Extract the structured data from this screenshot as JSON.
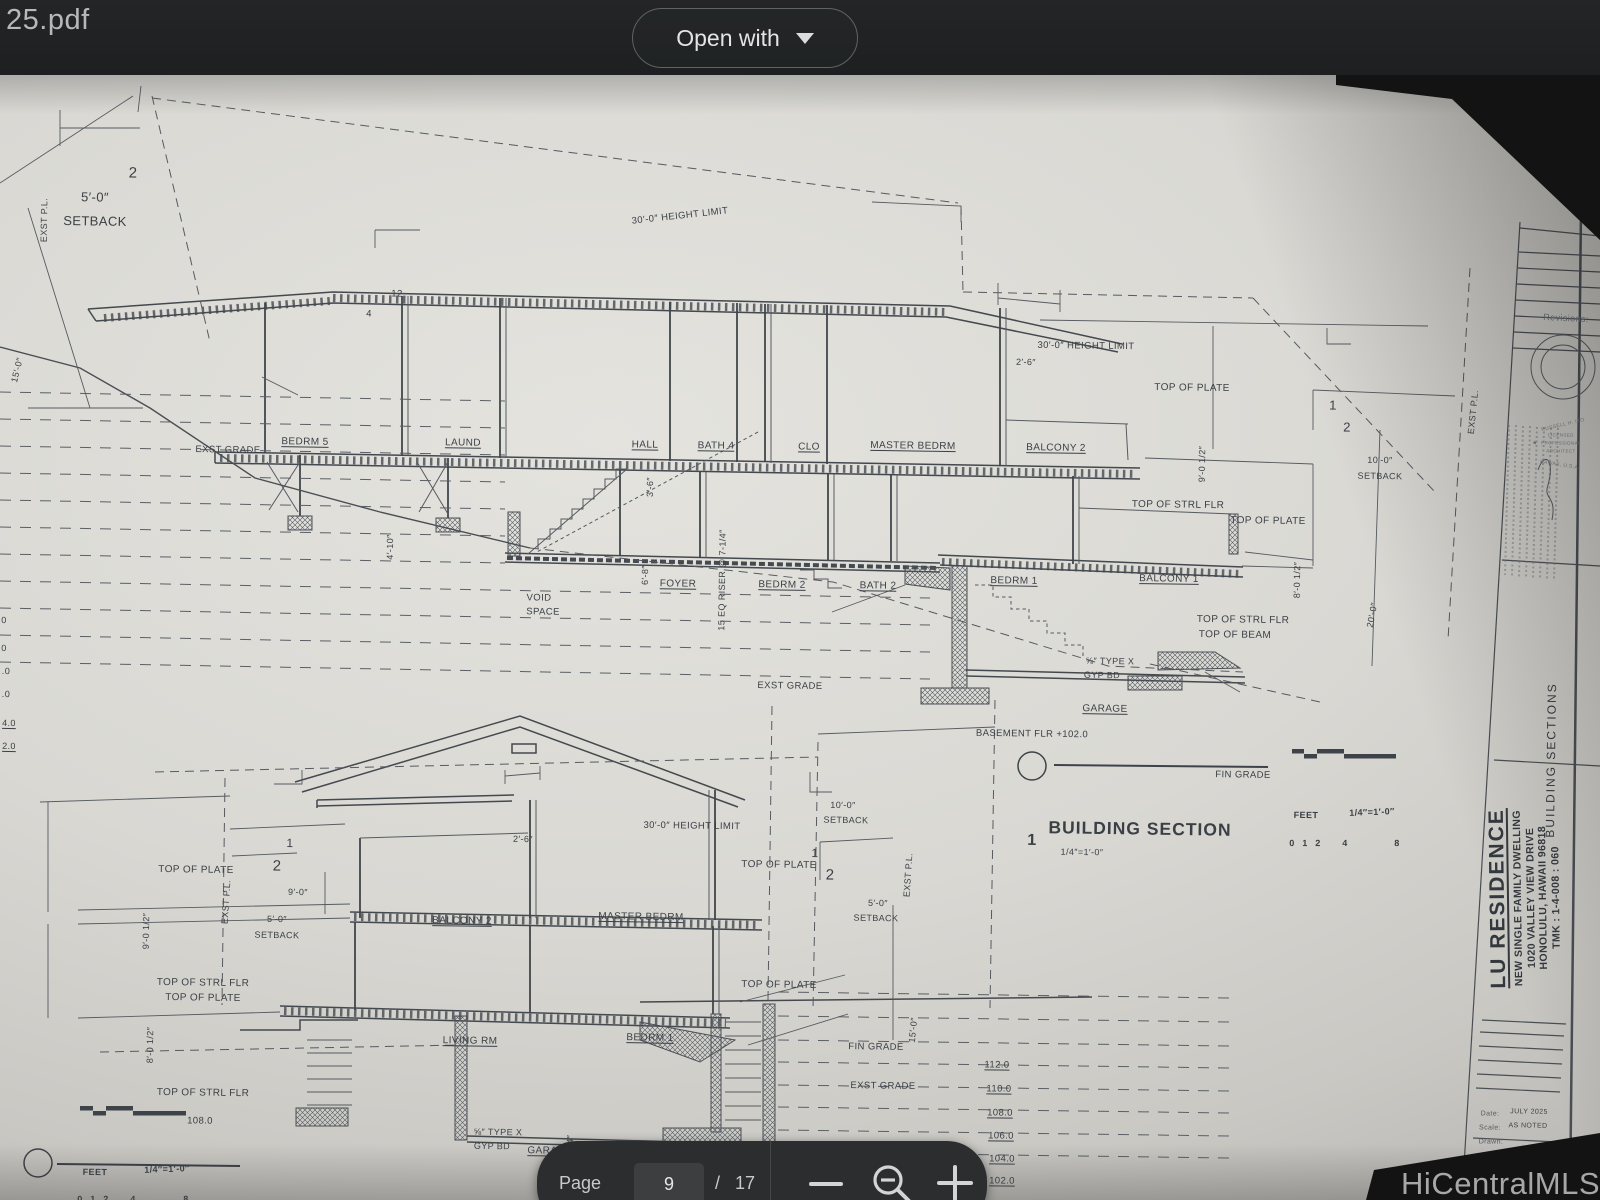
{
  "viewer": {
    "filename": "25.pdf",
    "open_with_label": "Open with",
    "page_label": "Page",
    "current_page": "9",
    "page_separator": "/",
    "total_pages": "17",
    "watermark": "HiCentralMLS"
  },
  "sheet": {
    "titleblock": {
      "project": "LU RESIDENCE",
      "line1": "NEW SINGLE FAMILY DWELLING",
      "line2": "1020 VALLEY VIEW DRIVE",
      "line3": "HONOLULU, HAWAII 96818",
      "line4": "TMK : 1-4-008 : 060"
    },
    "labels": [
      {
        "t": "2",
        "x": 133,
        "y": 98,
        "s": 15
      },
      {
        "t": "5′-0″",
        "x": 95,
        "y": 122,
        "s": 13
      },
      {
        "t": "SETBACK",
        "x": 95,
        "y": 146,
        "s": 13
      },
      {
        "t": "EXST P.L.",
        "x": 44,
        "y": 145,
        "r": -90,
        "s": 9
      },
      {
        "t": "15′-0″",
        "x": 17,
        "y": 295,
        "r": -77,
        "s": 9
      },
      {
        "t": "30′-0″ HEIGHT LIMIT",
        "x": 680,
        "y": 141,
        "r": -7,
        "s": 9.5
      },
      {
        "t": "12",
        "x": 397,
        "y": 219,
        "s": 9.5
      },
      {
        "t": "4",
        "x": 369,
        "y": 239,
        "s": 9.5
      },
      {
        "t": "EXST GRADE",
        "x": 228,
        "y": 375,
        "s": 9.5
      },
      {
        "t": "BEDRM 5",
        "x": 305,
        "y": 367,
        "u": 1
      },
      {
        "t": "LAUND",
        "x": 463,
        "y": 368,
        "u": 1
      },
      {
        "t": "HALL",
        "x": 645,
        "y": 370,
        "u": 1
      },
      {
        "t": "BATH 4",
        "x": 716,
        "y": 371,
        "u": 1
      },
      {
        "t": "CLO",
        "x": 809,
        "y": 372,
        "u": 1
      },
      {
        "t": "MASTER BEDRM",
        "x": 913,
        "y": 371,
        "u": 1
      },
      {
        "t": "BALCONY 2",
        "x": 1056,
        "y": 373,
        "u": 1
      },
      {
        "t": "30′-0″ HEIGHT LIMIT",
        "x": 1086,
        "y": 271,
        "s": 9.5
      },
      {
        "t": "2′-6″",
        "x": 1026,
        "y": 287,
        "s": 9
      },
      {
        "t": "TOP OF PLATE",
        "x": 1192,
        "y": 313
      },
      {
        "t": "EXST P.L.",
        "x": 1473,
        "y": 337,
        "r": -85,
        "s": 9
      },
      {
        "t": "10′-0″",
        "x": 1380,
        "y": 385,
        "s": 9
      },
      {
        "t": "SETBACK",
        "x": 1380,
        "y": 401,
        "s": 9
      },
      {
        "t": "1",
        "x": 1333,
        "y": 330,
        "s": 13
      },
      {
        "t": "2",
        "x": 1347,
        "y": 352,
        "s": 13
      },
      {
        "t": "9′-0 1/2″",
        "x": 1202,
        "y": 389,
        "r": -90,
        "s": 9
      },
      {
        "t": "3′-6″",
        "x": 650,
        "y": 412,
        "r": -90,
        "s": 9
      },
      {
        "t": "TOP OF STRL FLR",
        "x": 1178,
        "y": 430
      },
      {
        "t": "TOP OF PLATE",
        "x": 1268,
        "y": 446
      },
      {
        "t": "8′-0 1/2″",
        "x": 1297,
        "y": 505,
        "r": -90,
        "s": 9
      },
      {
        "t": "20′-0″",
        "x": 1372,
        "y": 540,
        "r": -80,
        "s": 9
      },
      {
        "t": "4′-10″",
        "x": 390,
        "y": 472,
        "r": -90,
        "s": 9
      },
      {
        "t": "6′-8″",
        "x": 645,
        "y": 500,
        "r": -90,
        "s": 9
      },
      {
        "t": "15 EQ RISER @ 7-1/4″",
        "x": 722,
        "y": 505,
        "r": -90,
        "s": 9
      },
      {
        "t": "FOYER",
        "x": 678,
        "y": 509,
        "u": 1
      },
      {
        "t": "BEDRM 2",
        "x": 782,
        "y": 510,
        "u": 1
      },
      {
        "t": "BATH 2",
        "x": 878,
        "y": 511,
        "u": 1
      },
      {
        "t": "BEDRM 1",
        "x": 1014,
        "y": 506,
        "u": 1
      },
      {
        "t": "BALCONY 1",
        "x": 1169,
        "y": 504,
        "u": 1
      },
      {
        "t": "VOID",
        "x": 539,
        "y": 523,
        "s": 9.5
      },
      {
        "t": "SPACE",
        "x": 543,
        "y": 537,
        "s": 9.5
      },
      {
        "t": "TOP OF STRL FLR",
        "x": 1243,
        "y": 545
      },
      {
        "t": "TOP OF BEAM",
        "x": 1235,
        "y": 560
      },
      {
        "t": "⅝″ TYPE X",
        "x": 1110,
        "y": 586,
        "s": 9
      },
      {
        "t": "GYP BD",
        "x": 1102,
        "y": 600,
        "s": 9
      },
      {
        "t": "EXST GRADE",
        "x": 790,
        "y": 611,
        "s": 9.5
      },
      {
        "t": "GARAGE",
        "x": 1105,
        "y": 634,
        "u": 1
      },
      {
        "t": "BASEMENT FLR +102.0",
        "x": 1032,
        "y": 659,
        "s": 9.5
      },
      {
        "t": "FIN GRADE",
        "x": 1243,
        "y": 700,
        "s": 9.5
      },
      {
        "t": "0",
        "x": 4,
        "y": 545,
        "s": 9
      },
      {
        "t": "0",
        "x": 4,
        "y": 573,
        "s": 9
      },
      {
        "t": ".0",
        "x": 6,
        "y": 596,
        "s": 9
      },
      {
        "t": ".0",
        "x": 6,
        "y": 619,
        "s": 9
      },
      {
        "t": "4.0",
        "x": 9,
        "y": 648,
        "s": 9,
        "u": 1
      },
      {
        "t": "2.0",
        "x": 9,
        "y": 671,
        "s": 9,
        "u": 1
      },
      {
        "t": "1",
        "x": 1032,
        "y": 766,
        "s": 16,
        "b": 1
      },
      {
        "t": "BUILDING SECTION",
        "x": 1140,
        "y": 754,
        "s": 17.5,
        "b": 1,
        "ls": 1
      },
      {
        "t": "1/4″=1′-0″",
        "x": 1082,
        "y": 777,
        "s": 9
      },
      {
        "t": "FEET",
        "x": 1306,
        "y": 740,
        "s": 9,
        "b": 1
      },
      {
        "t": "1/4″=1′-0″",
        "x": 1372,
        "y": 737,
        "s": 9,
        "b": 1,
        "r": -3
      },
      {
        "t": "0",
        "x": 1292,
        "y": 768,
        "s": 9,
        "b": 1
      },
      {
        "t": "1",
        "x": 1305,
        "y": 768,
        "s": 9,
        "b": 1
      },
      {
        "t": "2",
        "x": 1318,
        "y": 768,
        "s": 9,
        "b": 1
      },
      {
        "t": "4",
        "x": 1345,
        "y": 768,
        "s": 9,
        "b": 1
      },
      {
        "t": "8",
        "x": 1397,
        "y": 768,
        "s": 9,
        "b": 1
      },
      {
        "t": "TOP OF PLATE",
        "x": 196,
        "y": 795
      },
      {
        "t": "9′-0 1/2″",
        "x": 146,
        "y": 856,
        "r": -90,
        "s": 9
      },
      {
        "t": "EXST P.L.",
        "x": 226,
        "y": 827,
        "r": -87,
        "s": 9
      },
      {
        "t": "9′-0″",
        "x": 298,
        "y": 817,
        "s": 9
      },
      {
        "t": "5′-0″",
        "x": 277,
        "y": 844,
        "s": 9
      },
      {
        "t": "SETBACK",
        "x": 277,
        "y": 860,
        "s": 9
      },
      {
        "t": "1",
        "x": 290,
        "y": 768,
        "s": 12
      },
      {
        "t": "2",
        "x": 277,
        "y": 791,
        "s": 15
      },
      {
        "t": "2′-6″",
        "x": 523,
        "y": 764,
        "s": 9
      },
      {
        "t": "BALCONY 2",
        "x": 462,
        "y": 846,
        "u": 1
      },
      {
        "t": "MASTER BEDRM",
        "x": 641,
        "y": 842,
        "u": 1
      },
      {
        "t": "30′-0″ HEIGHT LIMIT",
        "x": 692,
        "y": 751,
        "s": 9.5
      },
      {
        "t": "TOP OF PLATE",
        "x": 779,
        "y": 790
      },
      {
        "t": "1",
        "x": 815,
        "y": 778,
        "s": 12
      },
      {
        "t": "2",
        "x": 830,
        "y": 800,
        "s": 15
      },
      {
        "t": "10′-0″",
        "x": 843,
        "y": 730,
        "s": 9
      },
      {
        "t": "SETBACK",
        "x": 846,
        "y": 745,
        "s": 9
      },
      {
        "t": "EXST P.L.",
        "x": 908,
        "y": 800,
        "r": -87,
        "s": 9
      },
      {
        "t": "5′-0″",
        "x": 878,
        "y": 828,
        "s": 9
      },
      {
        "t": "SETBACK",
        "x": 876,
        "y": 843,
        "s": 9
      },
      {
        "t": "TOP OF STRL FLR",
        "x": 203,
        "y": 908
      },
      {
        "t": "TOP OF PLATE",
        "x": 203,
        "y": 923
      },
      {
        "t": "8′-0 1/2″",
        "x": 150,
        "y": 970,
        "r": -90,
        "s": 9
      },
      {
        "t": "LIVING RM",
        "x": 470,
        "y": 966,
        "u": 1
      },
      {
        "t": "BEDRM 1",
        "x": 650,
        "y": 963,
        "u": 1
      },
      {
        "t": "TOP OF PLATE",
        "x": 779,
        "y": 910
      },
      {
        "t": "FIN GRADE",
        "x": 876,
        "y": 972,
        "s": 9.5
      },
      {
        "t": "EXST GRADE",
        "x": 883,
        "y": 1011,
        "s": 9.5
      },
      {
        "t": "15′-0″",
        "x": 913,
        "y": 955,
        "r": -85,
        "s": 9
      },
      {
        "t": "TOP OF STRL FLR",
        "x": 203,
        "y": 1018
      },
      {
        "t": "108.0",
        "x": 200,
        "y": 1046,
        "s": 9.5
      },
      {
        "t": "⅝″ TYPE X",
        "x": 498,
        "y": 1057,
        "s": 9
      },
      {
        "t": "GYP BD",
        "x": 492,
        "y": 1071,
        "s": 9
      },
      {
        "t": "GARAGE",
        "x": 550,
        "y": 1076,
        "u": 1
      },
      {
        "t": "8′-0 3/4″",
        "x": 570,
        "y": 1078,
        "r": -90,
        "s": 9
      },
      {
        "t": "112.0",
        "x": 997,
        "y": 990,
        "s": 9.5,
        "u": 1
      },
      {
        "t": "110.0",
        "x": 999,
        "y": 1014,
        "s": 9.5,
        "u": 1
      },
      {
        "t": "108.0",
        "x": 1000,
        "y": 1038,
        "s": 9.5,
        "u": 1
      },
      {
        "t": "106.0",
        "x": 1001,
        "y": 1061,
        "s": 9.5,
        "u": 1
      },
      {
        "t": "104.0",
        "x": 1002,
        "y": 1084,
        "s": 9.5,
        "u": 1
      },
      {
        "t": "102.0",
        "x": 1002,
        "y": 1106,
        "s": 9.5,
        "u": 1
      },
      {
        "t": "FEET",
        "x": 95,
        "y": 1097,
        "s": 9,
        "b": 1
      },
      {
        "t": "1/4″=1′-0″",
        "x": 167,
        "y": 1094,
        "s": 9,
        "b": 1,
        "r": -3
      },
      {
        "t": "0",
        "x": 80,
        "y": 1124,
        "s": 9,
        "b": 1
      },
      {
        "t": "1",
        "x": 93,
        "y": 1124,
        "s": 9,
        "b": 1
      },
      {
        "t": "2",
        "x": 106,
        "y": 1124,
        "s": 9,
        "b": 1
      },
      {
        "t": "4",
        "x": 133,
        "y": 1124,
        "s": 9,
        "b": 1
      },
      {
        "t": "8",
        "x": 186,
        "y": 1124,
        "s": 9,
        "b": 1
      },
      {
        "t": "2",
        "x": 38,
        "y": 1163,
        "s": 16,
        "b": 1
      },
      {
        "t": "BUILDING SECTION",
        "x": 149,
        "y": 1152,
        "s": 17.5,
        "b": 1,
        "ls": 1
      },
      {
        "t": "1/4″=1′-0″",
        "x": 90,
        "y": 1175,
        "s": 9
      },
      {
        "t": "Revisions:",
        "x": 1566,
        "y": 243,
        "s": 9,
        "c": "#5a5f65",
        "r": 2
      },
      {
        "t": "RUSSELL H. ITO",
        "x": 1563,
        "y": 350,
        "s": 5,
        "r": -14,
        "c": "#646970"
      },
      {
        "t": "LICENSED",
        "x": 1561,
        "y": 360,
        "s": 4.5,
        "c": "#646970"
      },
      {
        "t": "PROFESSIONAL",
        "x": 1561,
        "y": 368,
        "s": 4.5,
        "c": "#646970"
      },
      {
        "t": "ARCHITECT",
        "x": 1561,
        "y": 376,
        "s": 4.5,
        "c": "#646970"
      },
      {
        "t": "HAWAII, U.S.A.",
        "x": 1560,
        "y": 390,
        "s": 5,
        "r": 8,
        "c": "#646970"
      },
      {
        "t": "★",
        "x": 1535,
        "y": 368,
        "s": 6,
        "c": "#646970"
      },
      {
        "t": "BUILDING SECTIONS",
        "x": 1551,
        "y": 685,
        "r": -90,
        "s": 12,
        "ls": 2,
        "c": "#33383e"
      },
      {
        "t": "Date:",
        "x": 1490,
        "y": 1039,
        "s": 7,
        "c": "#555a60"
      },
      {
        "t": "JULY 2025",
        "x": 1529,
        "y": 1037,
        "s": 7
      },
      {
        "t": "Scale:",
        "x": 1490,
        "y": 1053,
        "s": 7,
        "c": "#555a60"
      },
      {
        "t": "AS NOTED",
        "x": 1528,
        "y": 1051,
        "s": 7
      },
      {
        "t": "Drawn:",
        "x": 1491,
        "y": 1067,
        "s": 7,
        "c": "#555a60"
      },
      {
        "t": "Job:",
        "x": 1488,
        "y": 1081,
        "s": 7,
        "c": "#555a60"
      },
      {
        "t": "Drawing No:",
        "x": 1510,
        "y": 1100,
        "s": 7,
        "c": "#555a60"
      },
      {
        "t": "A008",
        "x": 1515,
        "y": 1122,
        "s": 24,
        "ls": 1,
        "c": "#2f343a"
      },
      {
        "t": "I",
        "x": 1563,
        "y": 1100,
        "s": 16
      },
      {
        "t": "of",
        "x": 1512,
        "y": 1148,
        "s": 7.5
      },
      {
        "t": "Sheets",
        "x": 1546,
        "y": 1148,
        "s": 7.5
      }
    ]
  }
}
